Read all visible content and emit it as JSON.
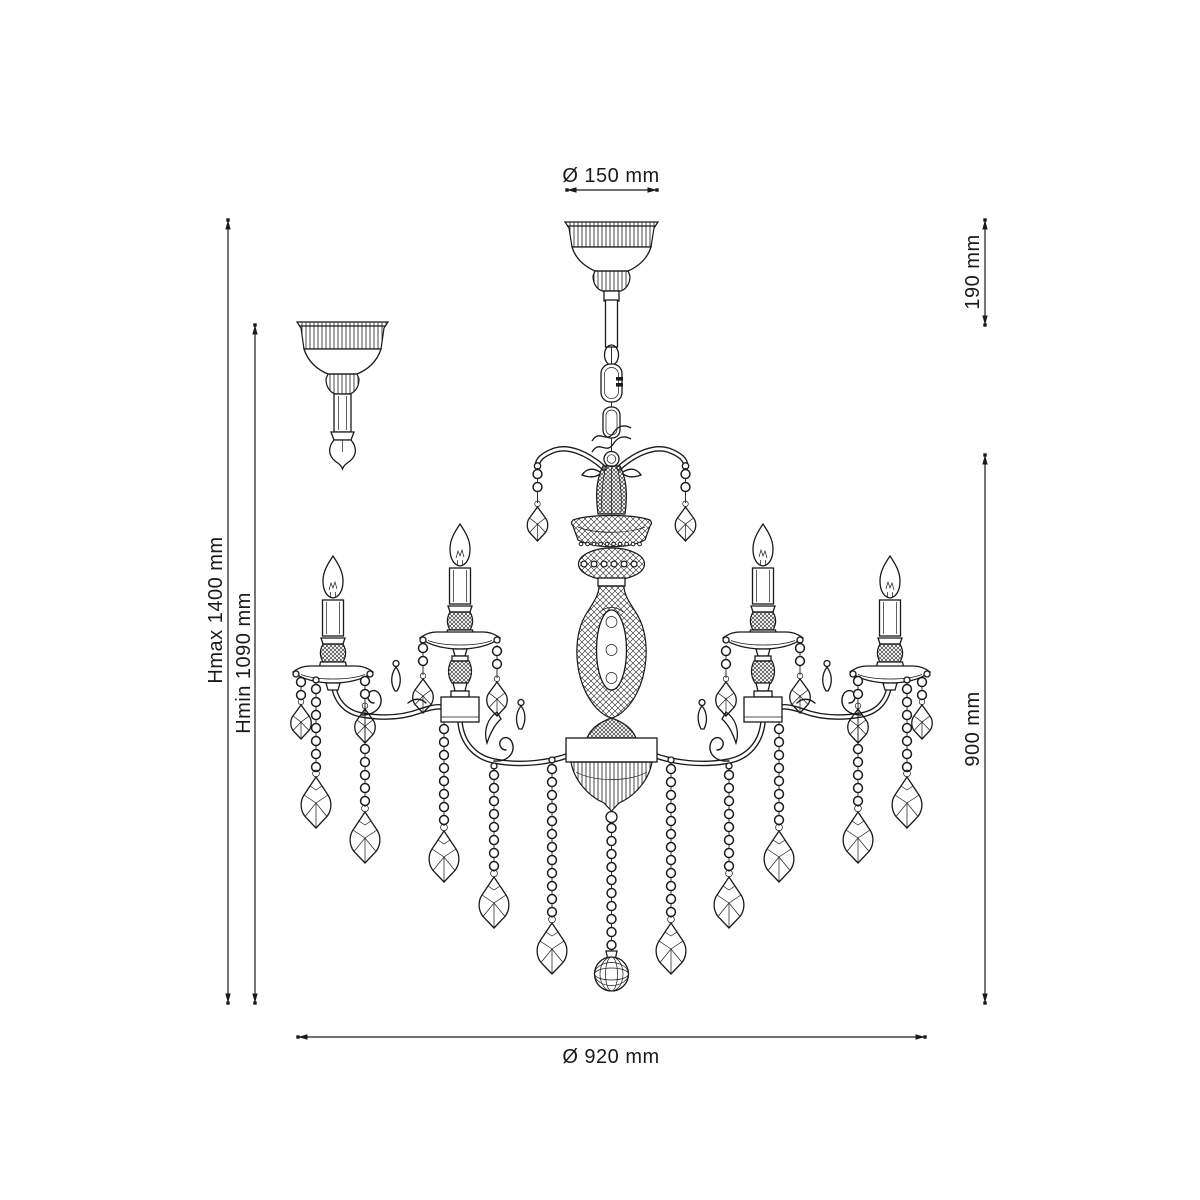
{
  "page": {
    "background": "#ffffff",
    "line_color": "#1a1a1a",
    "content": "technical dimension drawing of a five-light crystal chandelier with ceiling canopy, chain suspension, scroll arms, candle lights and crystal bead drops"
  },
  "dimensions": {
    "top_diameter": {
      "label": "Ø 150 mm"
    },
    "suspension_height": {
      "label": "190 mm"
    },
    "height_max": {
      "label": "Hmax 1400 mm"
    },
    "height_min": {
      "label": "Hmin 1090 mm"
    },
    "body_height": {
      "label": "900 mm"
    },
    "body_diameter": {
      "label": "Ø 920 mm"
    }
  }
}
